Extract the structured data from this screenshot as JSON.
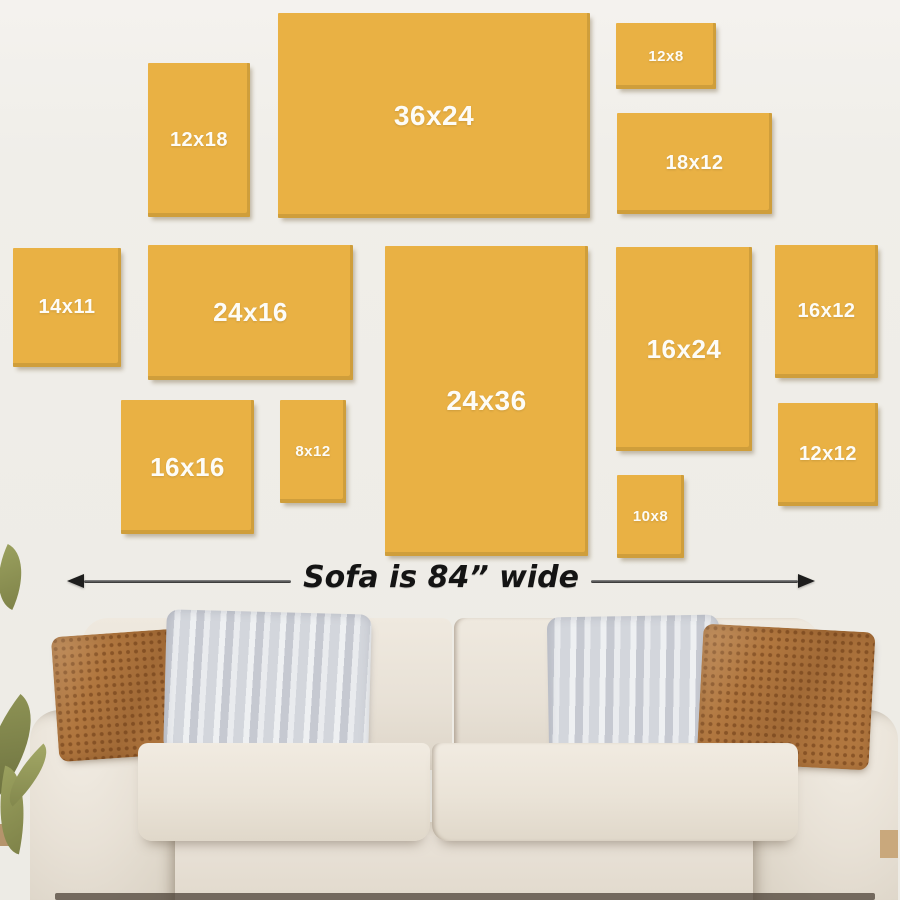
{
  "colors": {
    "wall": "#f0eee9",
    "panel": "#e9b144",
    "panel_label": "#fdfcf7",
    "arrow": "#1d1d1d",
    "annotation_text": "#141414",
    "sofa_body": "#e8e1d6",
    "pillow_brown": "#b1773f",
    "pillow_gray": "#d6d8dd",
    "leaf_green": "#7f8349"
  },
  "panels": [
    {
      "label": "36x24",
      "x": 278,
      "y": 13,
      "w": 312,
      "h": 205,
      "size": "xl"
    },
    {
      "label": "12x18",
      "x": 148,
      "y": 63,
      "w": 102,
      "h": 154,
      "size": "md"
    },
    {
      "label": "12x8",
      "x": 616,
      "y": 23,
      "w": 100,
      "h": 66,
      "size": "sm"
    },
    {
      "label": "18x12",
      "x": 617,
      "y": 113,
      "w": 155,
      "h": 101,
      "size": "md"
    },
    {
      "label": "14x11",
      "x": 13,
      "y": 248,
      "w": 108,
      "h": 119,
      "size": "md"
    },
    {
      "label": "24x16",
      "x": 148,
      "y": 245,
      "w": 205,
      "h": 135,
      "size": "lg"
    },
    {
      "label": "24x36",
      "x": 385,
      "y": 246,
      "w": 203,
      "h": 310,
      "size": "xl"
    },
    {
      "label": "16x24",
      "x": 616,
      "y": 247,
      "w": 136,
      "h": 204,
      "size": "lg"
    },
    {
      "label": "16x12",
      "x": 775,
      "y": 245,
      "w": 103,
      "h": 133,
      "size": "md"
    },
    {
      "label": "16x16",
      "x": 121,
      "y": 400,
      "w": 133,
      "h": 134,
      "size": "lg"
    },
    {
      "label": "8x12",
      "x": 280,
      "y": 400,
      "w": 66,
      "h": 103,
      "size": "sm"
    },
    {
      "label": "10x8",
      "x": 617,
      "y": 475,
      "w": 67,
      "h": 83,
      "size": "sm"
    },
    {
      "label": "12x12",
      "x": 778,
      "y": 403,
      "w": 100,
      "h": 103,
      "size": "md"
    }
  ],
  "annotation": {
    "text": "Sofa is 84” wide",
    "arrow": {
      "x1": 67,
      "x2": 815,
      "y": 581
    }
  }
}
